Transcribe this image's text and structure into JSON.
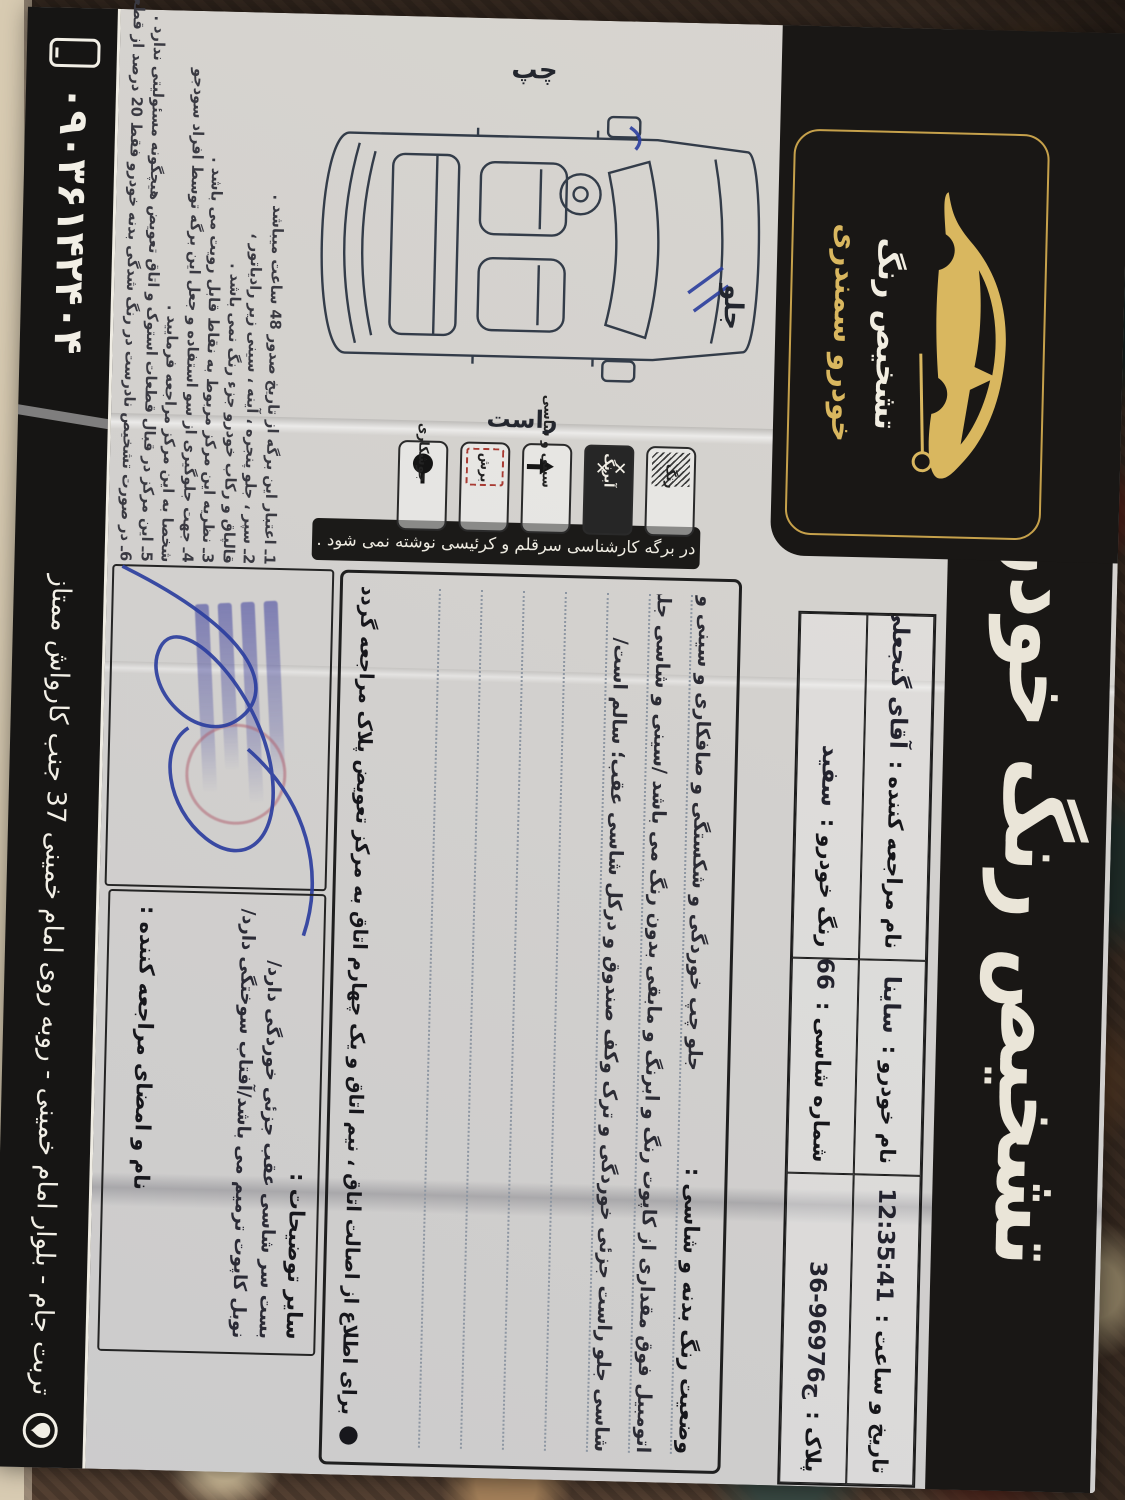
{
  "header": {
    "title": "تشخیص رنگ خودرو سمندری",
    "logo_line1": "تشخیص رنگ",
    "logo_line2": "خودرو سمندری"
  },
  "info": {
    "date_label": "تاریخ و ساعت :",
    "time_value": "12:35:41",
    "date_value": "1404/08/12",
    "car_label": "نام خودرو :",
    "car_value": "ساینا",
    "client_label": "نام مراجعه کننده :",
    "client_value": "آقای گنجعلی",
    "plate_label": "پلاک :",
    "plate_value": "36-969ج76",
    "chassis_label": "شماره شاسی :",
    "chassis_value": "751966",
    "color_label": "رنگ خودرو :",
    "color_value": "سفید"
  },
  "note_strip": "در برگه کارشناسی سرقلم و کرئیسی نوشته نمی شود .",
  "legend": [
    {
      "label": "رنگ"
    },
    {
      "label": "آبرنگ"
    },
    {
      "label": "سینی و شاسی"
    },
    {
      "label": "برش"
    },
    {
      "label": "جوشکاری"
    }
  ],
  "diagram_labels": {
    "front": "جلو",
    "left": "چپ",
    "right": "راست"
  },
  "findings": {
    "heading": "وضعیت رنگ بدنه و شاسی :",
    "line1": "جلو چپ خوردگی و شکستگی و صافکاری و سینی و",
    "line2": "اتومبیل فوق مقداری از کاپوت رنگ و ابرنگ و مابقی بدون رنگ می باشد /سینی و شاسی جلو چپ",
    "line3": "شاسی جلو راست جزئی خوردگی و ترک وکف صندوق و درکل شاسی عقب؛ سالم است/",
    "footnote_bullet": "●",
    "footnote": "برای اطلاع از اصالت اتاق ، نیم اتاق و یک چهارم اتاق به مرکز تعویض پلاک مراجعه گردد ."
  },
  "other_box": {
    "heading": "سایر توضیحات :",
    "line1": "بست سر شاسی عقب جزئی خوردگی دارد/",
    "line2": "نوبل کاپوت ترمیم می باشد/آفتاب سوختگی دارد/",
    "signature_label": "نام و امضای مراجعه کننده :"
  },
  "notes": [
    "1ـ اعتبار این برگه از تاریخ صدور 48 ساعت میباشد .",
    "2ـ سپر ، جلو پنجره ، آینه ، سینی زیر رادیاتور ،",
    "قالپاق و رکاب خودرو جزء رنگ نمی باشد .",
    "3ـ نظریه این مرکز مربوط به نقاط قابل رویت می باشد .",
    "4ـ جهت جلوگیری از سو استفاده و جعل این برگه توسط افراد سودجو",
    "شخصا به این مرکز مراجعه فرمایید .",
    "5ـ این مرکز در قبال قطعات استوک و اتاق تعویض هیچگونه مسئولیتی ندارد .",
    "6ـ در صورت تشخیص نادرست در رنگ شدگی بدنه خودرو فقط 20 درصد از قطعه پرداخت می شود ."
  ],
  "footer": {
    "address": "تربت جام - بلوار امام خمینی - روبه روی امام خمینی 37 جنب کارواش ممتاز",
    "phone": "۰۹۰۳۶۱۴۲۴۰۴"
  },
  "colors": {
    "band_black": "#191715",
    "gold": "#d9b75f",
    "paper": "#e3e1dd",
    "pen_blue": "#2b3e9e",
    "stamp_blue": "#4648a0"
  }
}
